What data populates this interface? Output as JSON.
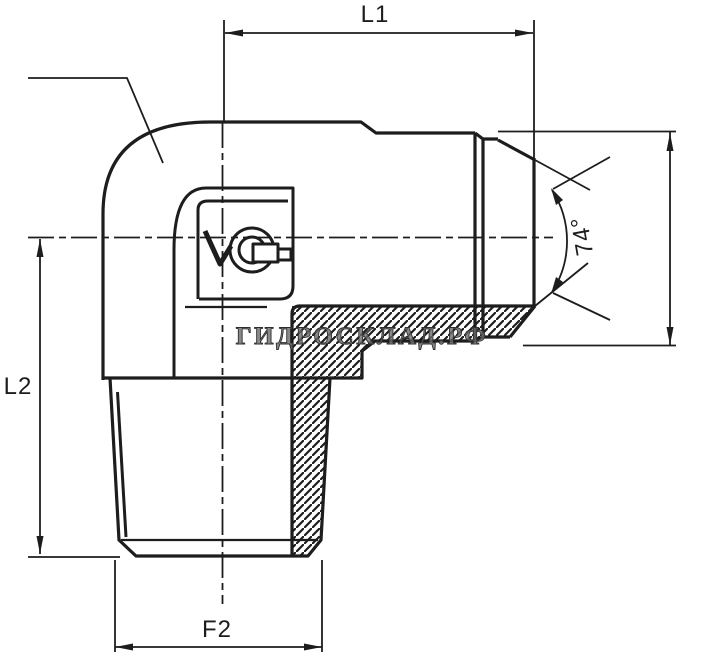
{
  "drawing": {
    "type": "technical-drawing",
    "subject": "90-degree elbow hydraulic adapter fitting, half-section view",
    "labels": {
      "l1": "L1",
      "l2": "L2",
      "f2": "F2",
      "flare_angle": "74°"
    },
    "watermark": "ГИДРОСКЛАД.РФ",
    "colors": {
      "background": "#ffffff",
      "line": "#1d1d1d",
      "watermark": "#6b6b6b"
    }
  }
}
